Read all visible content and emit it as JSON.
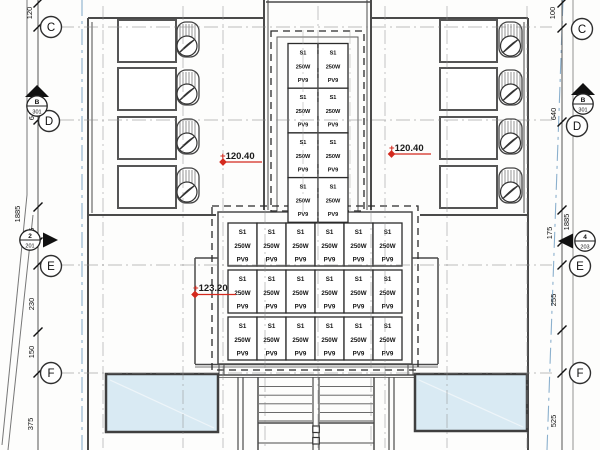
{
  "drawing": {
    "type": "roof-floor-plan",
    "colors": {
      "red": "#d42a1e",
      "blue_boundary": "#7fa8c9",
      "wall": "#4a4a4a",
      "canopy_fill": "#d9eaf3"
    },
    "grid": {
      "left_bubbles": [
        {
          "label": "C"
        },
        {
          "label": "D"
        },
        {
          "label": "E"
        },
        {
          "label": "F"
        }
      ],
      "right_bubbles": [
        {
          "label": "C"
        },
        {
          "label": "D"
        },
        {
          "label": "E"
        },
        {
          "label": "F"
        }
      ]
    },
    "dimensions": {
      "left": [
        "120",
        "640",
        "1885",
        "175",
        "230",
        "150",
        "375"
      ],
      "right": [
        "100",
        "640",
        "1885",
        "175",
        "255",
        "525"
      ]
    },
    "section_markers": [
      {
        "ref": "B",
        "sheet": "301",
        "position": "left-top"
      },
      {
        "ref": "B",
        "sheet": "301",
        "position": "right-top"
      },
      {
        "ref": "2",
        "sheet": "201",
        "position": "left-mid"
      },
      {
        "ref": "4",
        "sheet": "203",
        "position": "right-mid"
      }
    ],
    "elevations": [
      {
        "prefix": "+",
        "value": "120.40",
        "area": "left-roof"
      },
      {
        "prefix": "+",
        "value": "120.40",
        "area": "right-roof"
      },
      {
        "prefix": "+",
        "value": "123.20",
        "area": "center-roof"
      }
    ],
    "pv_panel": {
      "model": "S1",
      "power": "250W",
      "code": "PV9"
    },
    "pv_arrays": [
      {
        "name": "top-array",
        "cols": 2,
        "rows": 4
      },
      {
        "name": "center-array",
        "cols": 6,
        "rows": 3
      }
    ],
    "ac_units": {
      "left": 4,
      "right": 4
    }
  }
}
